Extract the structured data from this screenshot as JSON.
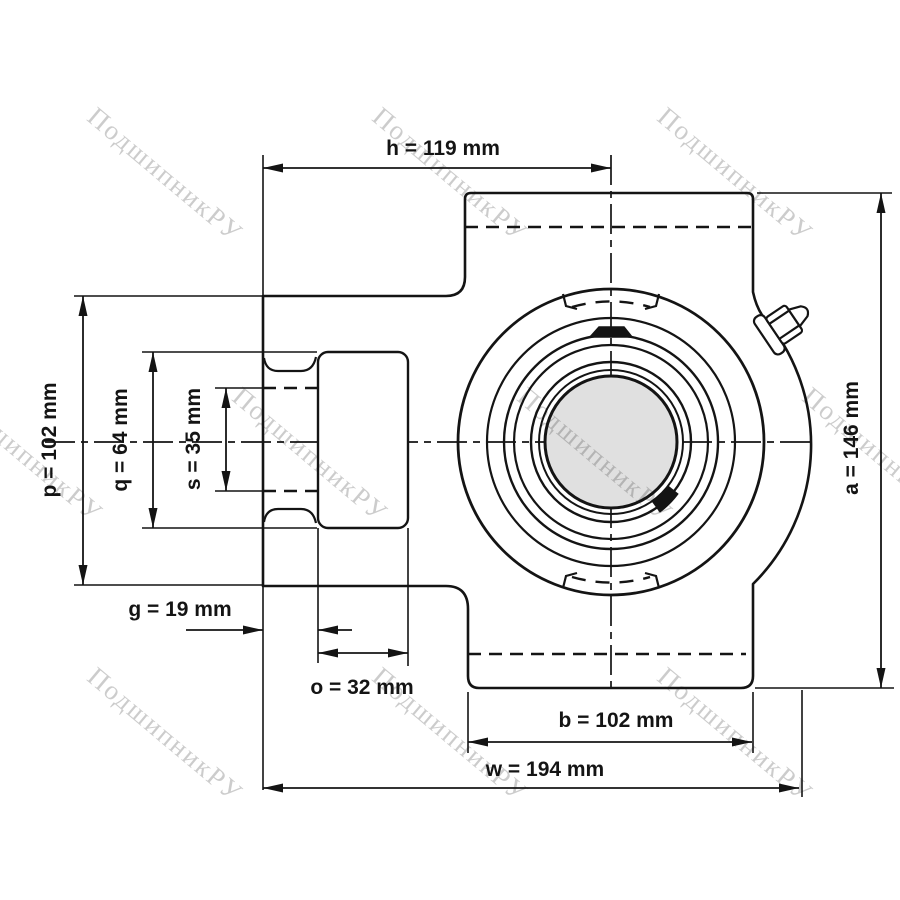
{
  "watermark": {
    "text": "ПодшипникРУ"
  },
  "colors": {
    "line": "#141414",
    "bore_fill": "#e0e0e0",
    "watermark_gray": "#c8c8c8"
  },
  "dimensions": {
    "h": {
      "name": "h",
      "value": 119,
      "unit": "mm",
      "label": "h = 119 mm"
    },
    "p": {
      "name": "p",
      "value": 102,
      "unit": "mm",
      "label": "p = 102 mm"
    },
    "q": {
      "name": "q",
      "value": 64,
      "unit": "mm",
      "label": "q = 64 mm"
    },
    "s": {
      "name": "s",
      "value": 35,
      "unit": "mm",
      "label": "s = 35 mm"
    },
    "g": {
      "name": "g",
      "value": 19,
      "unit": "mm",
      "label": "g = 19 mm"
    },
    "o": {
      "name": "o",
      "value": 32,
      "unit": "mm",
      "label": "o = 32 mm"
    },
    "b": {
      "name": "b",
      "value": 102,
      "unit": "mm",
      "label": "b = 102 mm"
    },
    "w": {
      "name": "w",
      "value": 194,
      "unit": "mm",
      "label": "w = 194 mm"
    },
    "a": {
      "name": "a",
      "value": 146,
      "unit": "mm",
      "label": "a = 146 mm"
    }
  }
}
